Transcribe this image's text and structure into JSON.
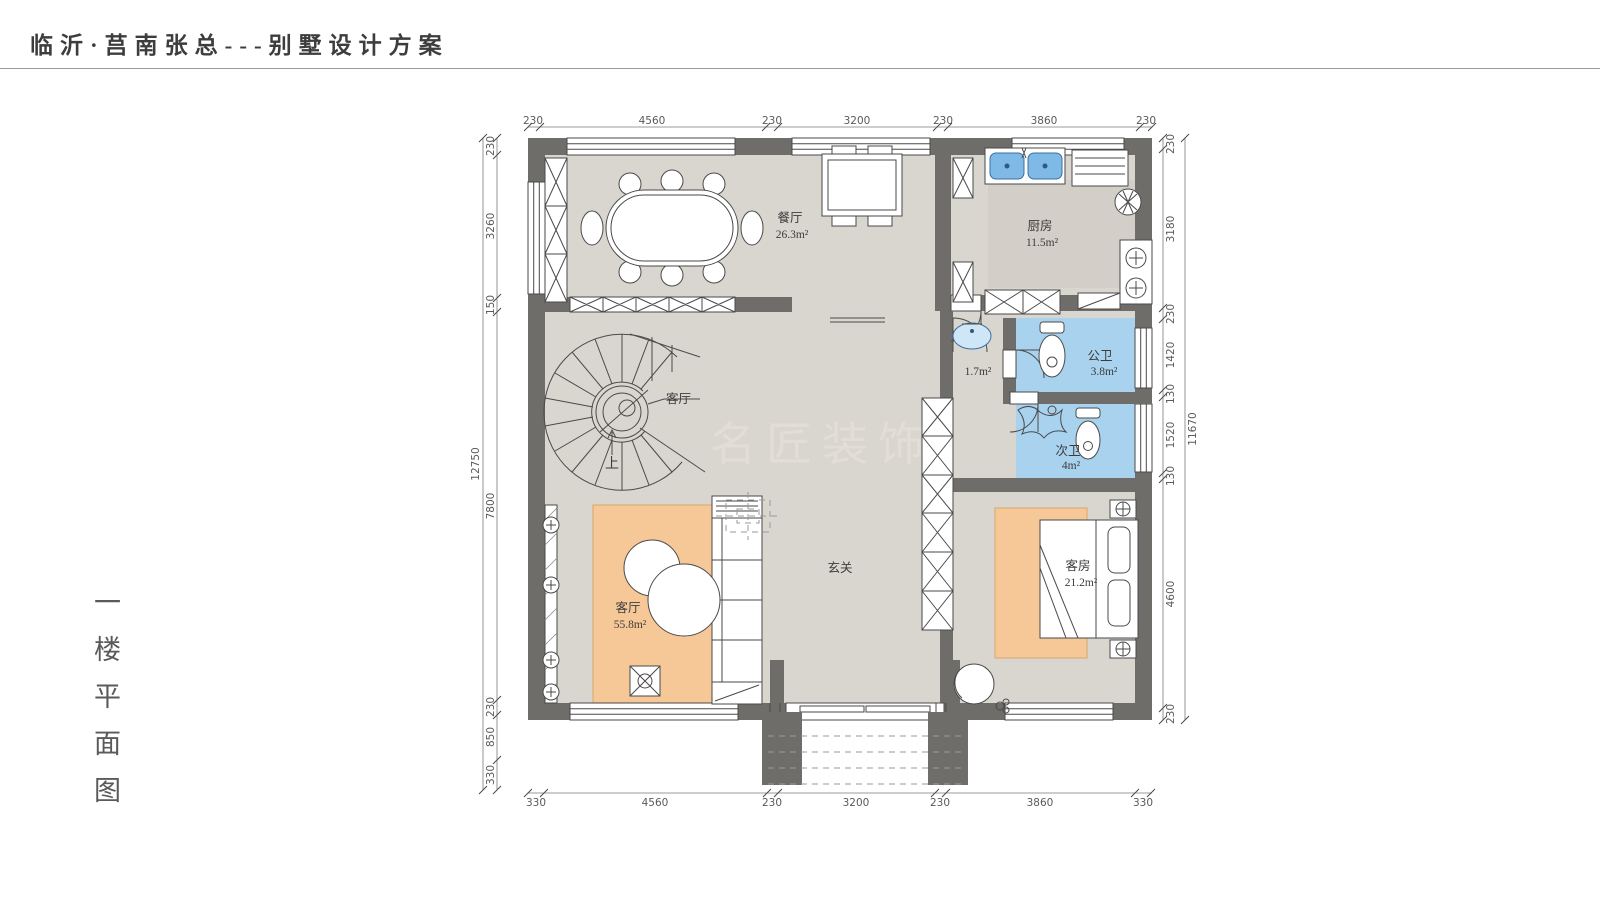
{
  "page": {
    "title": "临沂·莒南张总---别墅设计方案",
    "floor_label": "一楼平面图",
    "watermark": "名匠装饰"
  },
  "rooms": {
    "dining": {
      "name": "餐厅",
      "area": "26.3m²"
    },
    "kitchen": {
      "name": "厨房",
      "area": "11.5m²"
    },
    "wash": {
      "area": "1.7m²"
    },
    "public_bath": {
      "name": "公卫",
      "area": "3.8m²"
    },
    "second_bath": {
      "name": "次卫",
      "area": "4m²"
    },
    "living": {
      "name": "客厅",
      "area": "55.8m²"
    },
    "guest": {
      "name": "客房",
      "area": "21.2m²"
    },
    "entry": {
      "name": "玄关"
    },
    "stair": {
      "callout": "客厅",
      "up": "上"
    }
  },
  "dimensions": {
    "top": [
      "230",
      "4560",
      "230",
      "3200",
      "230",
      "3860",
      "230"
    ],
    "bottom": [
      "330",
      "4560",
      "230",
      "3200",
      "230",
      "3860",
      "330"
    ],
    "left": [
      "230",
      "3260",
      "150",
      "7800",
      "230",
      "850",
      "330"
    ],
    "left_overall": "12750",
    "right": [
      "230",
      "3180",
      "230",
      "1420",
      "130",
      "1520",
      "130",
      "4600",
      "230"
    ],
    "right_overall": "11670"
  },
  "colors": {
    "wall": "#6f6d6a",
    "floor": "#d9d5cf",
    "bath_floor": "#a9d2ef",
    "sink_blue": "#7fb9e6",
    "rug_orange": "#f6c797"
  }
}
